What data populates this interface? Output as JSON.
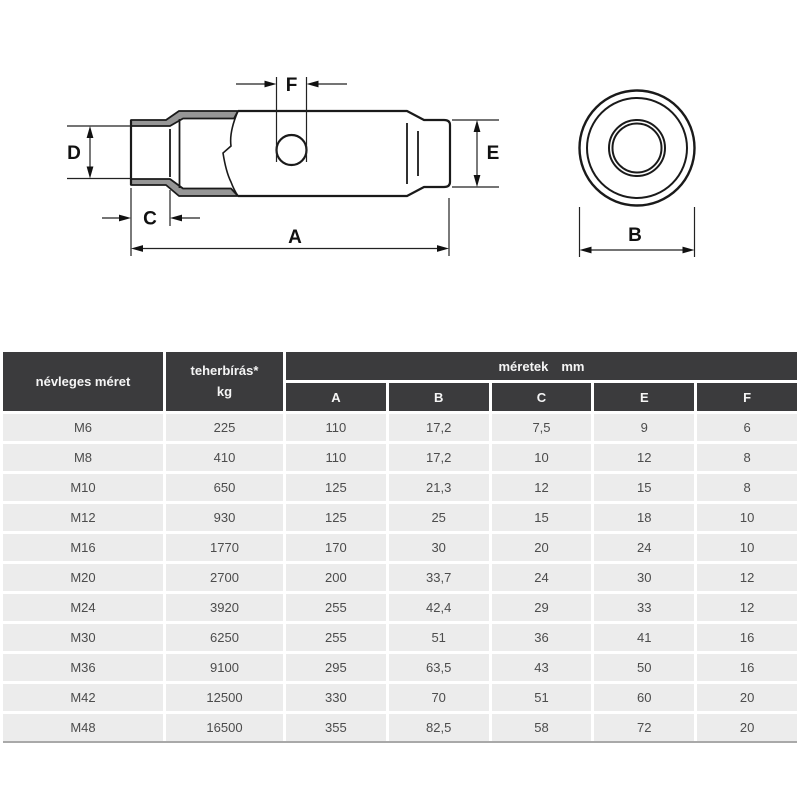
{
  "drawing": {
    "labels": {
      "A": "A",
      "B": "B",
      "C": "C",
      "D": "D",
      "E": "E",
      "F": "F"
    },
    "colors": {
      "line": "#1a1a1a",
      "section_fill": "#969696",
      "dim_line": "#222222"
    }
  },
  "table": {
    "header": {
      "nominal_size": "névleges méret",
      "load_line1": "teherbírás*",
      "load_line2": "kg",
      "dims_word1": "méretek",
      "dims_word2": "mm",
      "dim_columns": [
        "A",
        "B",
        "C",
        "E",
        "F"
      ]
    },
    "rows": [
      {
        "size": "M6",
        "load": "225",
        "a": "110",
        "b": "17,2",
        "c": "7,5",
        "e": "9",
        "f": "6"
      },
      {
        "size": "M8",
        "load": "410",
        "a": "110",
        "b": "17,2",
        "c": "10",
        "e": "12",
        "f": "8"
      },
      {
        "size": "M10",
        "load": "650",
        "a": "125",
        "b": "21,3",
        "c": "12",
        "e": "15",
        "f": "8"
      },
      {
        "size": "M12",
        "load": "930",
        "a": "125",
        "b": "25",
        "c": "15",
        "e": "18",
        "f": "10"
      },
      {
        "size": "M16",
        "load": "1770",
        "a": "170",
        "b": "30",
        "c": "20",
        "e": "24",
        "f": "10"
      },
      {
        "size": "M20",
        "load": "2700",
        "a": "200",
        "b": "33,7",
        "c": "24",
        "e": "30",
        "f": "12"
      },
      {
        "size": "M24",
        "load": "3920",
        "a": "255",
        "b": "42,4",
        "c": "29",
        "e": "33",
        "f": "12"
      },
      {
        "size": "M30",
        "load": "6250",
        "a": "255",
        "b": "51",
        "c": "36",
        "e": "41",
        "f": "16"
      },
      {
        "size": "M36",
        "load": "9100",
        "a": "295",
        "b": "63,5",
        "c": "43",
        "e": "50",
        "f": "16"
      },
      {
        "size": "M42",
        "load": "12500",
        "a": "330",
        "b": "70",
        "c": "51",
        "e": "60",
        "f": "20"
      },
      {
        "size": "M48",
        "load": "16500",
        "a": "355",
        "b": "82,5",
        "c": "58",
        "e": "72",
        "f": "20"
      }
    ],
    "colors": {
      "header_bg": "#3b3b3d",
      "header_text": "#f5f5f5",
      "row_bg": "#ececec",
      "row_text": "#4c4c4c"
    }
  }
}
